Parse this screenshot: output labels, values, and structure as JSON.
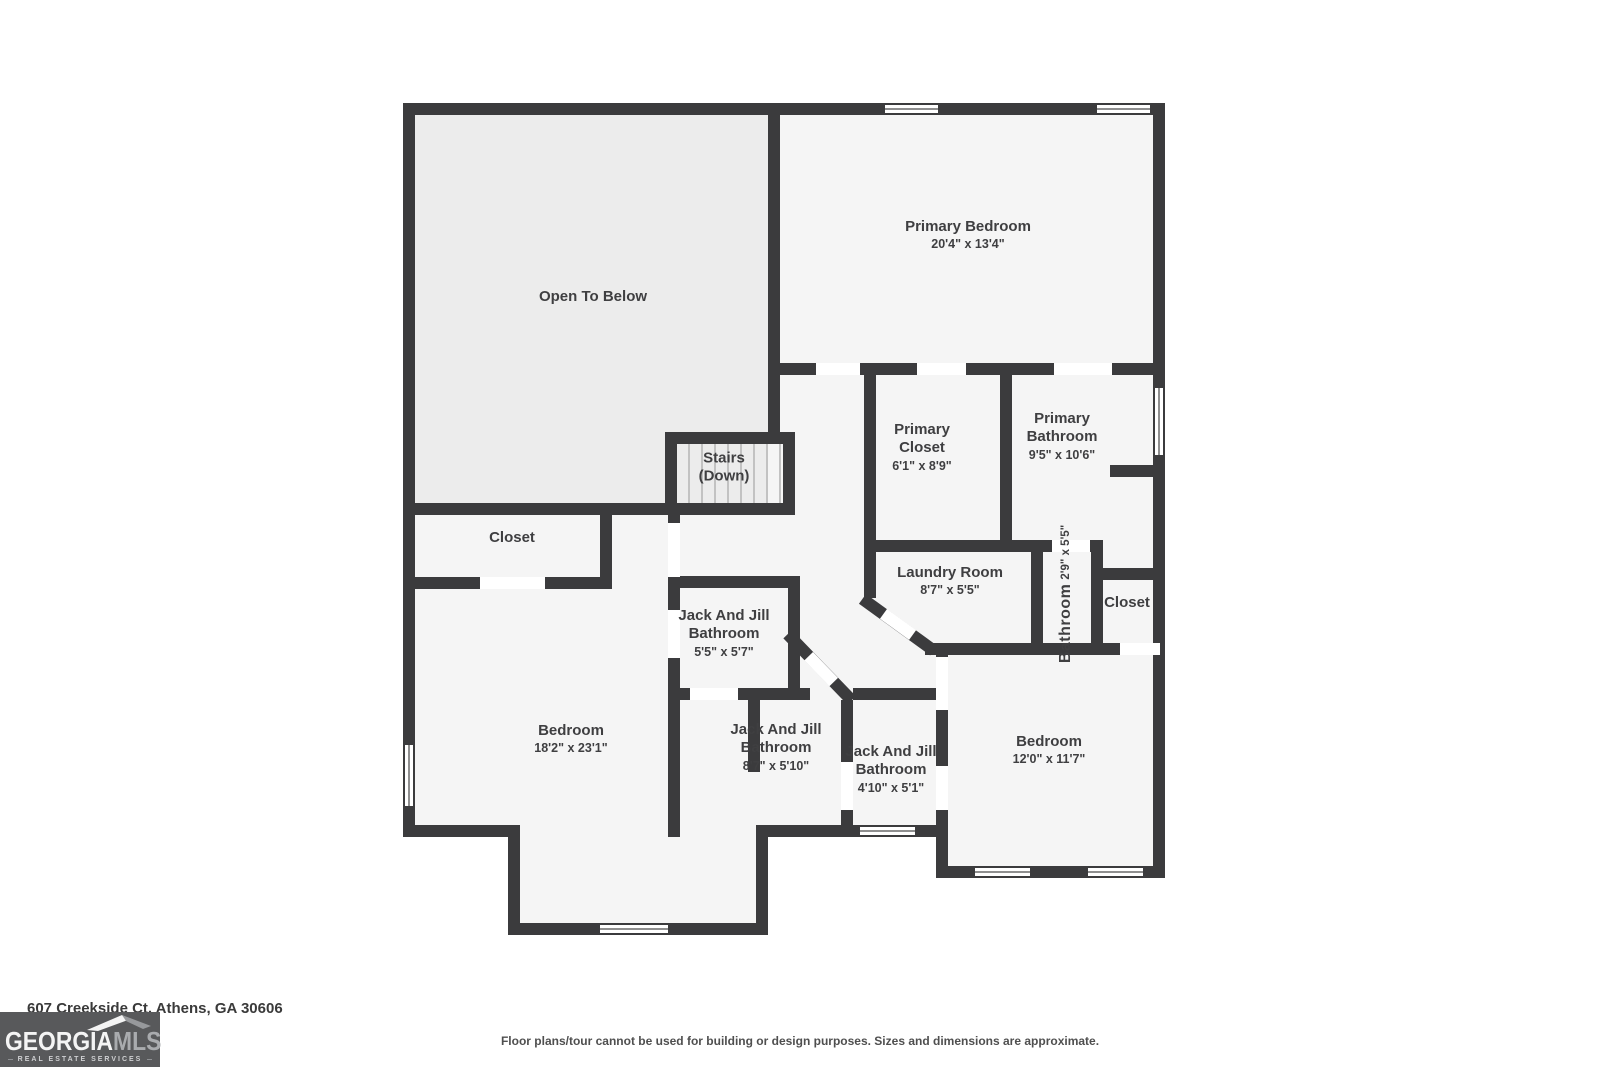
{
  "plan": {
    "rooms": [
      {
        "name": "Open To Below",
        "dims": ""
      },
      {
        "name": "Primary Bedroom",
        "dims": "20'4\" x 13'4\""
      },
      {
        "name": "Primary Closet",
        "dims": "6'1\" x 8'9\""
      },
      {
        "name": "Primary Bathroom",
        "dims": "9'5\" x 10'6\""
      },
      {
        "name": "Stairs (Down)",
        "dims": ""
      },
      {
        "name": "Closet",
        "dims": ""
      },
      {
        "name": "Laundry Room",
        "dims": "8'7\" x 5'5\""
      },
      {
        "name": "Bathroom",
        "dims": "2'9\" x 5'5\""
      },
      {
        "name": "Closet",
        "dims": ""
      },
      {
        "name": "Jack And Jill Bathroom",
        "dims": "5'5\" x 5'7\""
      },
      {
        "name": "Jack And Jill Bathroom",
        "dims": "8'7\" x 5'10\""
      },
      {
        "name": "Jack And Jill Bathroom",
        "dims": "4'10\" x 5'1\""
      },
      {
        "name": "Bedroom",
        "dims": "18'2\" x 23'1\""
      },
      {
        "name": "Bedroom",
        "dims": "12'0\" x 11'7\""
      }
    ]
  },
  "footer": {
    "address": "607 Creekside Ct, Athens, GA 30606",
    "disclaimer": "Floor plans/tour cannot be used for building or design purposes. Sizes and dimensions are approximate."
  },
  "logo": {
    "georgia": "GEORGIA",
    "mls": "MLS",
    "tagline": "REAL ESTATE SERVICES"
  },
  "colors": {
    "wall": "#3b3b3d",
    "room_fill": "#f5f5f5",
    "open_to_below_fill": "#ececec",
    "logo_background": "#58595b",
    "logo_mls_text": "#a9abae"
  }
}
